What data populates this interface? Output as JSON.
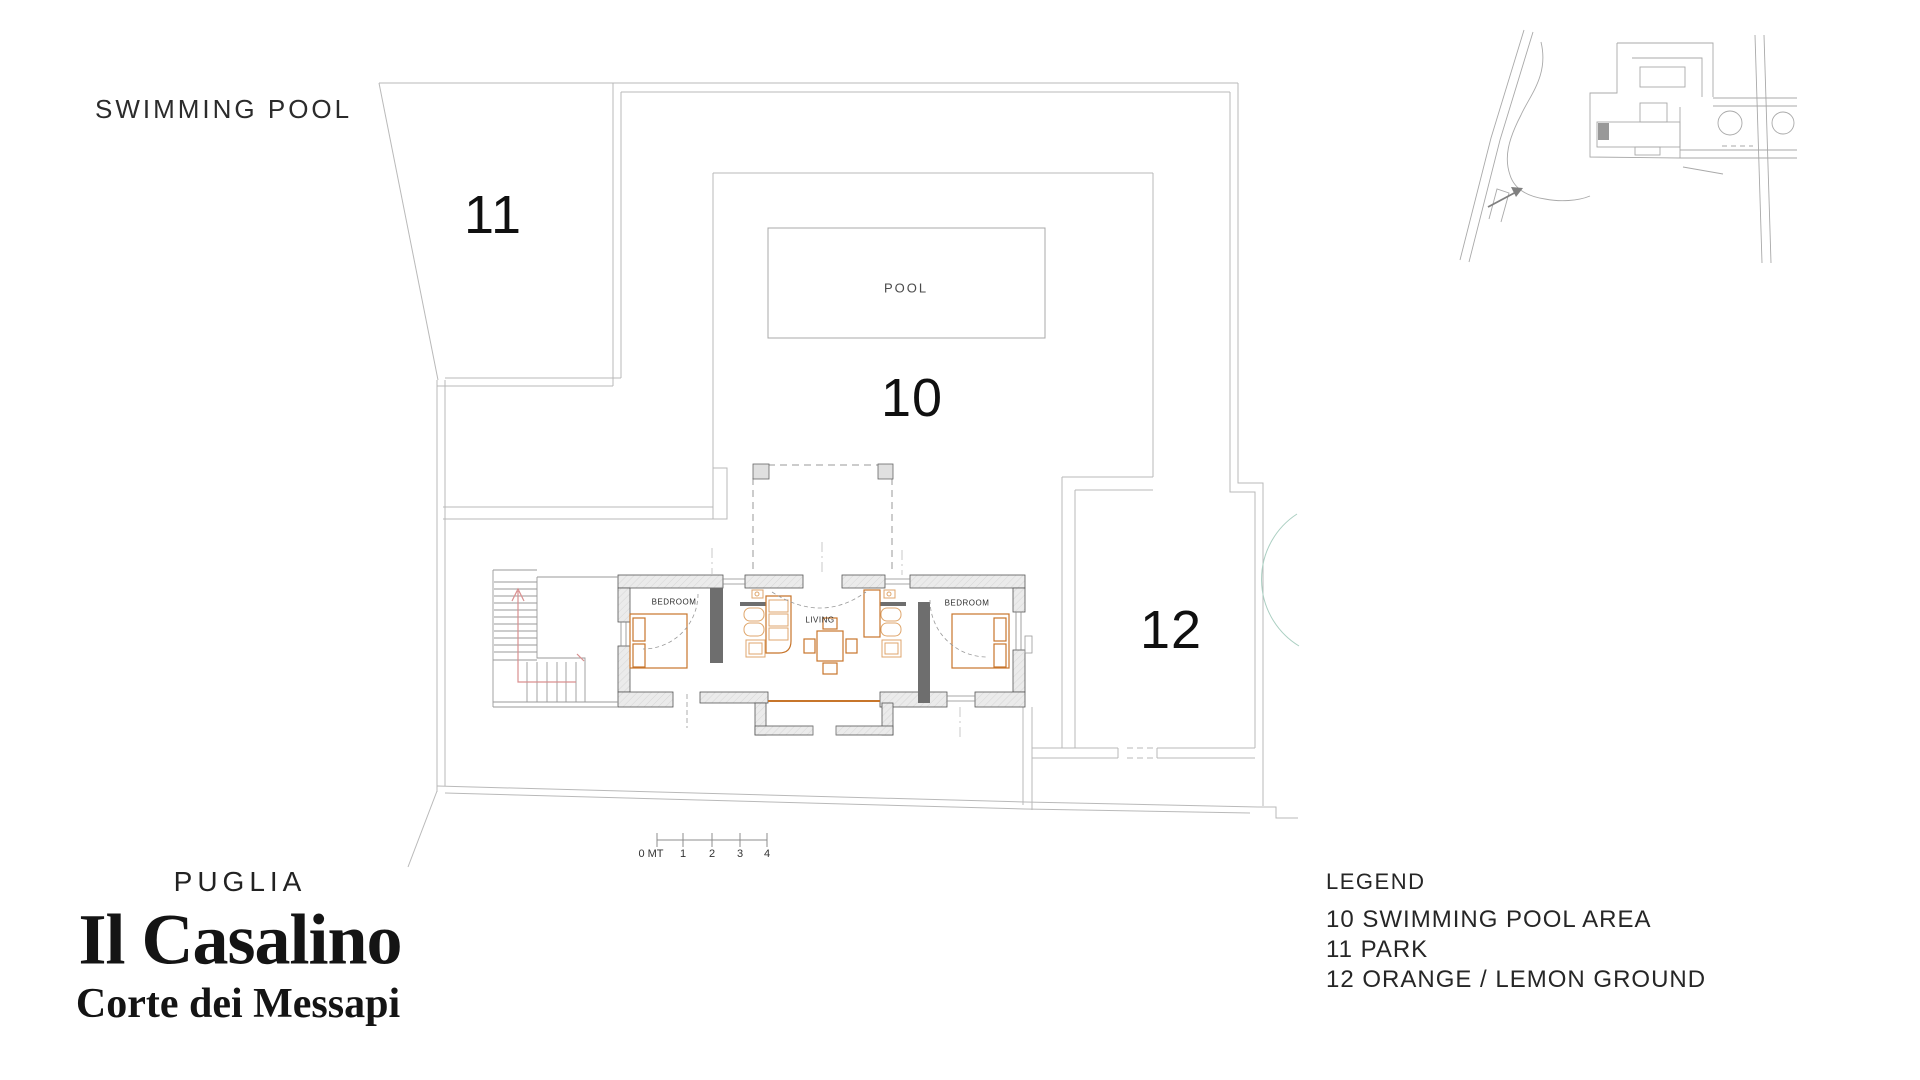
{
  "header": {
    "area_title": "SWIMMING POOL"
  },
  "plan": {
    "area_labels": {
      "pool_area": "10",
      "park": "11",
      "orange_ground": "12"
    },
    "room_labels": {
      "pool": "POOL",
      "living": "LIVING",
      "bedroom_left": "BEDROOM",
      "bedroom_right": "BEDROOM"
    },
    "scale_bar": {
      "zero_label": "0 MT",
      "ticks": [
        "1",
        "2",
        "3",
        "4"
      ]
    }
  },
  "title_block": {
    "region": "PUGLIA",
    "property_name": "Il Casalino",
    "estate_name": "Corte dei Messapi"
  },
  "legend": {
    "title": "LEGEND",
    "items": [
      {
        "number": "10",
        "label": "SWIMMING POOL AREA"
      },
      {
        "number": "11",
        "label": "PARK"
      },
      {
        "number": "12",
        "label": "ORANGE / LEMON GROUND"
      }
    ]
  },
  "icons": {
    "entrance_arrow": "arrow-up-right-icon"
  },
  "colors": {
    "plan_line": "#b9b9b9",
    "wall_outline": "#555555",
    "wall_fill": "#ebebeb",
    "furniture_orange": "#c7752b",
    "fixture_orange": "#dfa66c",
    "stair_arrow_red": "#d98f8f",
    "tree_teal": "#abcfc2",
    "text_dark": "#1d1d1d"
  }
}
